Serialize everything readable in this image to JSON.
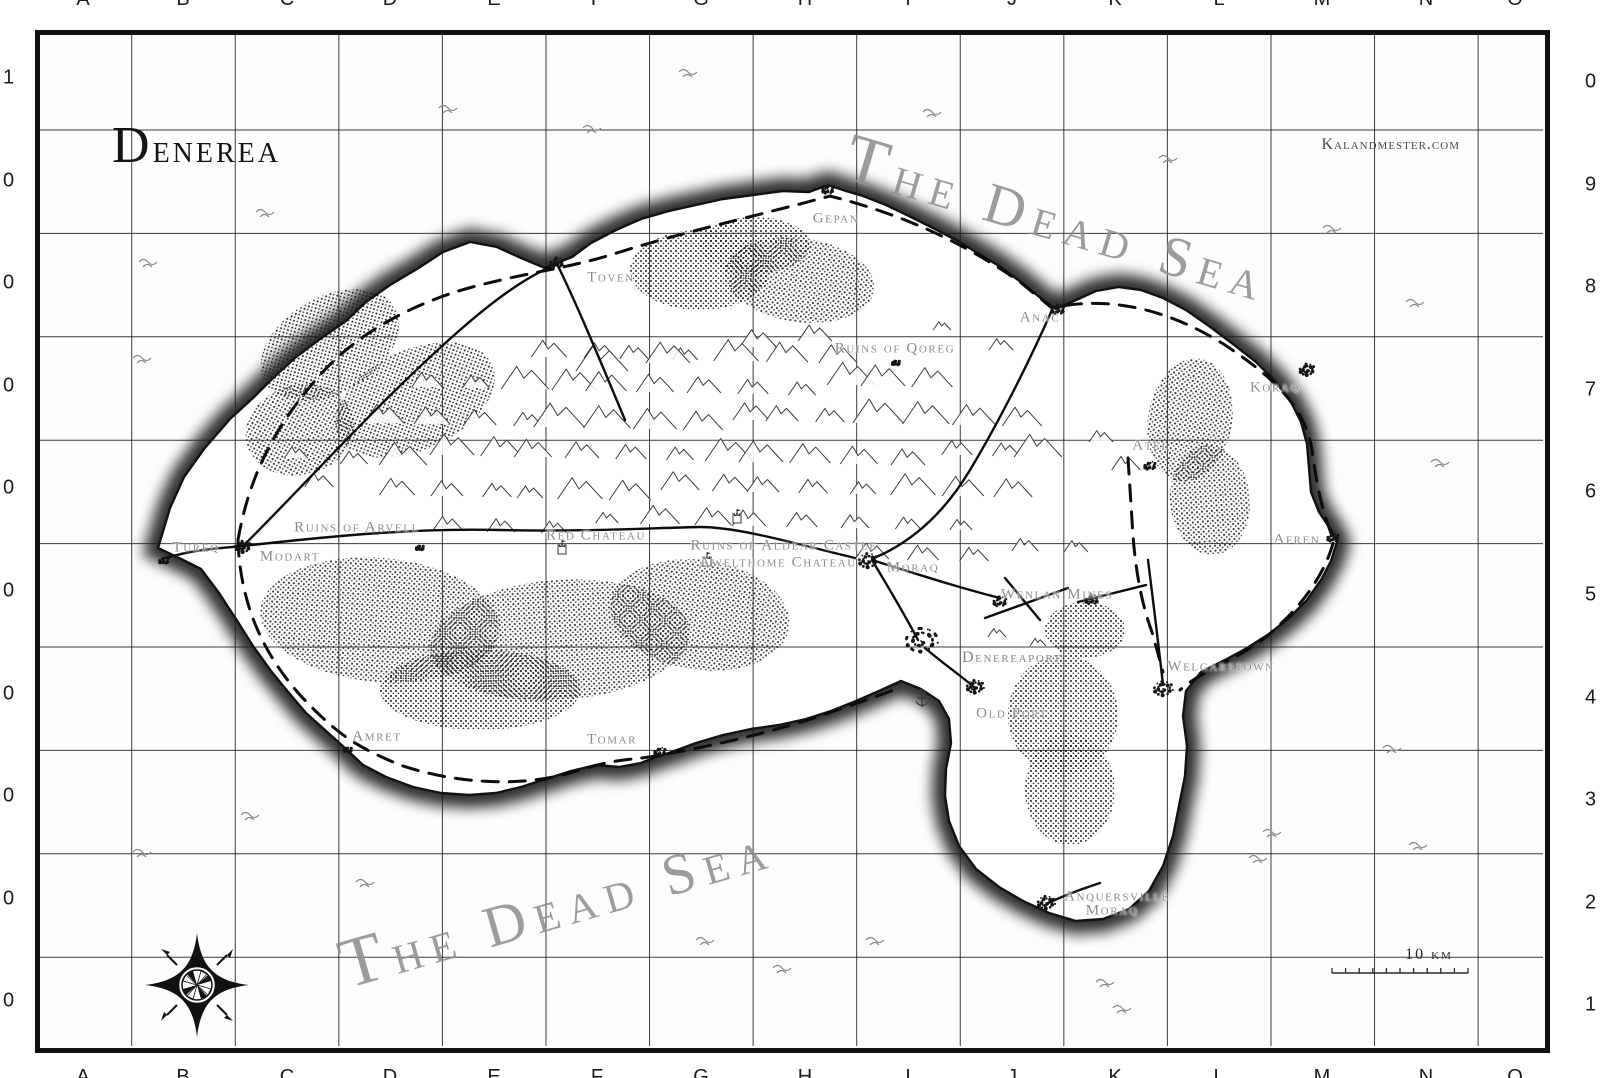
{
  "map": {
    "title": "Denerea",
    "attribution": "Kalandmester.com",
    "sea_label": "The Dead Sea",
    "grid": {
      "top_letters": [
        "A",
        "B",
        "C",
        "D",
        "E",
        "F",
        "G",
        "H",
        "I",
        "J",
        "K",
        "L",
        "M",
        "N",
        "O"
      ],
      "bottom_letters": [
        "A",
        "B",
        "C",
        "D",
        "E",
        "F",
        "G",
        "H",
        "I",
        "J",
        "K",
        "L",
        "M",
        "N",
        "O"
      ],
      "left_numbers_visible": [
        "1",
        "0",
        "0",
        "0",
        "0",
        "0",
        "0",
        "0",
        "0",
        "0"
      ],
      "right_numbers_visible": [
        "0",
        "9",
        "8",
        "7",
        "6",
        "5",
        "4",
        "3",
        "2",
        "1"
      ]
    },
    "scale": {
      "label": "10 km",
      "label_x": 1429,
      "label_y": 955,
      "bar_x1": 1332,
      "bar_x2": 1468,
      "bar_y": 973
    },
    "labels": [
      {
        "t": "Gepan",
        "x": 836,
        "y": 219
      },
      {
        "t": "Toven",
        "x": 611,
        "y": 278
      },
      {
        "t": "Anac",
        "x": 1040,
        "y": 318
      },
      {
        "t": "Ruins of Qoreg",
        "x": 895,
        "y": 349
      },
      {
        "t": "Koraq",
        "x": 1275,
        "y": 388
      },
      {
        "t": "Atel",
        "x": 1151,
        "y": 446
      },
      {
        "t": "Afren",
        "x": 1297,
        "y": 540
      },
      {
        "t": "Tureq",
        "x": 196,
        "y": 548
      },
      {
        "t": "Modart",
        "x": 290,
        "y": 557
      },
      {
        "t": "Ruins of Arvell",
        "x": 357,
        "y": 528
      },
      {
        "t": "Red Chateau",
        "x": 596,
        "y": 536
      },
      {
        "t": "Ruins of Aldear Castle",
        "x": 784,
        "y": 546
      },
      {
        "t": "Awelthome Chateau",
        "x": 778,
        "y": 563
      },
      {
        "t": "Moraq",
        "x": 913,
        "y": 568
      },
      {
        "t": "Wenlan Mines",
        "x": 1057,
        "y": 595
      },
      {
        "t": "Denereaport",
        "x": 1012,
        "y": 658,
        "big": true
      },
      {
        "t": "Old Port",
        "x": 1012,
        "y": 714
      },
      {
        "t": "Welgarstown",
        "x": 1221,
        "y": 667
      },
      {
        "t": "Amret",
        "x": 377,
        "y": 737
      },
      {
        "t": "Tomar",
        "x": 612,
        "y": 740
      },
      {
        "t": "Anquersville",
        "x": 1117,
        "y": 897
      },
      {
        "t": "Moraq",
        "x": 1112,
        "y": 911
      }
    ],
    "markers": [
      {
        "n": "tureq",
        "x": 164,
        "y": 561,
        "r": 5
      },
      {
        "n": "modart",
        "x": 243,
        "y": 547,
        "r": 8
      },
      {
        "n": "toven",
        "x": 557,
        "y": 263,
        "r": 7
      },
      {
        "n": "gepan",
        "x": 828,
        "y": 190,
        "r": 6
      },
      {
        "n": "anac",
        "x": 1058,
        "y": 310,
        "r": 7
      },
      {
        "n": "koraq",
        "x": 1307,
        "y": 370,
        "r": 8
      },
      {
        "n": "atel",
        "x": 1150,
        "y": 466,
        "r": 6
      },
      {
        "n": "afren",
        "x": 1333,
        "y": 538,
        "r": 6
      },
      {
        "n": "moraq",
        "x": 868,
        "y": 561,
        "r": 10
      },
      {
        "n": "denereaport",
        "x": 921,
        "y": 641,
        "r": 17
      },
      {
        "n": "old-port",
        "x": 975,
        "y": 687,
        "r": 9
      },
      {
        "n": "welgarstown",
        "x": 1163,
        "y": 689,
        "r": 10
      },
      {
        "n": "anquersville-moraq",
        "x": 1046,
        "y": 903,
        "r": 9
      },
      {
        "n": "tomar",
        "x": 660,
        "y": 752,
        "r": 6
      },
      {
        "n": "amret",
        "x": 348,
        "y": 750,
        "r": 4
      },
      {
        "n": "wenlan-mines-west",
        "x": 1000,
        "y": 602,
        "r": 7
      },
      {
        "n": "wenlan-mines-east",
        "x": 1092,
        "y": 600,
        "r": 7
      },
      {
        "n": "ruins-of-qoreg",
        "x": 896,
        "y": 363,
        "r": 4
      },
      {
        "n": "ruins-of-arvell",
        "x": 420,
        "y": 548,
        "r": 4
      }
    ],
    "castles": [
      {
        "n": "red-chateau",
        "x": 562,
        "y": 549
      },
      {
        "n": "aldear-castle",
        "x": 737,
        "y": 518
      },
      {
        "n": "awelthome-chateau",
        "x": 707,
        "y": 561
      }
    ],
    "anchor": {
      "x": 922,
      "y": 700
    },
    "island_path": "M158,548 L170,508 L184,477 L204,449 L230,419 L254,397 L272,379 L296,357 L320,339 L346,321 L366,302 L390,285 L417,269 L443,252 L470,242 L497,247 L521,258 L545,268 L557,263 L572,257 L591,243 L616,230 L641,219 L669,211 L696,205 L723,199 L753,195 L783,191 L809,192 L828,185 L846,191 L863,196 L886,205 L909,216 L933,228 L956,240 L976,252 L999,266 L1021,282 L1043,300 L1056,309 L1076,300 L1096,291 L1119,287 L1141,290 L1163,298 L1186,310 L1209,326 L1233,344 L1256,362 L1276,382 L1291,402 L1301,422 L1307,444 L1309,468 L1311,492 L1319,512 L1331,530 L1337,542 L1331,561 L1321,580 L1307,600 L1289,618 L1269,634 L1247,648 L1225,660 L1201,672 L1186,691 L1183,716 L1187,746 L1185,776 L1179,806 L1173,836 L1163,866 L1149,891 L1129,909 L1103,919 L1076,921 L1049,913 L1023,901 L999,887 L976,869 L959,846 L949,821 L945,796 L946,769 L951,743 L949,719 L939,701 L921,689 L901,681 L879,691 L856,701 L831,711 L806,719 L779,725 L751,729 L723,735 L696,743 L669,753 L656,757 L641,763 L619,767 L596,765 L571,771 L546,779 L521,787 L496,793 L469,795 L441,793 L413,787 L386,777 L363,765 L346,749 L326,731 L306,713 L289,693 L271,671 L253,646 L236,619 L219,593 L201,569 L181,559 Z",
    "routes_dashed": [
      "M238,540 C250,470 280,420 320,375 C360,330 420,300 480,285 C540,270 570,268 620,252 C680,233 760,215 830,196 C900,214 960,240 1020,282 L1052,308 C1110,295 1170,310 1225,345 C1270,375 1305,405 1312,450 C1318,495 1325,520 1334,540 C1325,575 1300,610 1262,640 C1230,663 1200,672 1180,690",
      "M238,540 C240,600 260,650 300,695 C340,738 360,748 400,765 C450,782 520,790 580,770 C620,757 640,760 660,755 C700,748 760,736 820,716 C860,702 880,695 900,688",
      "M1128,458 L1132,520 C1134,560 1140,600 1152,632 L1163,672"
    ],
    "routes_solid": [
      "M165,558 C200,548 225,548 243,546",
      "M243,546 C300,490 380,400 460,330 C500,295 530,275 557,264",
      "M557,264 C575,300 600,360 625,420",
      "M243,546 C340,535 420,528 500,530 C580,532 650,528 700,527 C740,527 800,545 855,558",
      "M1052,310 C1030,360 1000,420 970,470 C940,520 905,545 874,558",
      "M872,560 C890,590 905,615 918,640",
      "M872,560 C920,575 960,588 1000,598",
      "M985,618 L1068,588",
      "M1078,602 L1146,585",
      "M1005,578 L1040,620",
      "M925,648 C945,665 960,675 975,688",
      "M1163,685 C1158,640 1153,600 1148,560",
      "M1048,903 C1070,893 1085,888 1100,883"
    ],
    "forests": [
      {
        "cx": 330,
        "cy": 345,
        "rx": 75,
        "ry": 48,
        "rot": -30
      },
      {
        "cx": 415,
        "cy": 400,
        "rx": 85,
        "ry": 50,
        "rot": -25
      },
      {
        "cx": 300,
        "cy": 430,
        "rx": 55,
        "ry": 45,
        "rot": -15
      },
      {
        "cx": 700,
        "cy": 270,
        "rx": 70,
        "ry": 40,
        "rot": 0
      },
      {
        "cx": 800,
        "cy": 280,
        "rx": 75,
        "ry": 42,
        "rot": 8
      },
      {
        "cx": 755,
        "cy": 245,
        "rx": 55,
        "ry": 28,
        "rot": 0
      },
      {
        "cx": 1190,
        "cy": 420,
        "rx": 42,
        "ry": 62,
        "rot": 10
      },
      {
        "cx": 1210,
        "cy": 500,
        "rx": 40,
        "ry": 55,
        "rot": -5
      },
      {
        "cx": 380,
        "cy": 620,
        "rx": 120,
        "ry": 62,
        "rot": 5
      },
      {
        "cx": 560,
        "cy": 640,
        "rx": 130,
        "ry": 60,
        "rot": -4
      },
      {
        "cx": 700,
        "cy": 615,
        "rx": 90,
        "ry": 55,
        "rot": 8
      },
      {
        "cx": 480,
        "cy": 690,
        "rx": 100,
        "ry": 40,
        "rot": 0
      },
      {
        "cx": 1063,
        "cy": 715,
        "rx": 55,
        "ry": 60,
        "rot": 0
      },
      {
        "cx": 1070,
        "cy": 790,
        "rx": 45,
        "ry": 55,
        "rot": 0
      },
      {
        "cx": 1085,
        "cy": 630,
        "rx": 40,
        "ry": 28,
        "rot": 0
      }
    ],
    "mountain_rows": [
      {
        "y": 358,
        "x0": 545,
        "x1": 880,
        "step": 48,
        "s": 16
      },
      {
        "y": 390,
        "x0": 430,
        "x1": 960,
        "step": 46,
        "s": 17
      },
      {
        "y": 425,
        "x0": 385,
        "x1": 1025,
        "step": 45,
        "s": 18
      },
      {
        "y": 460,
        "x0": 355,
        "x1": 1090,
        "step": 46,
        "s": 17
      },
      {
        "y": 495,
        "x0": 395,
        "x1": 1050,
        "step": 47,
        "s": 16
      },
      {
        "y": 528,
        "x0": 455,
        "x1": 1000,
        "step": 50,
        "s": 14
      },
      {
        "y": 556,
        "x0": 880,
        "x1": 1080,
        "step": 48,
        "s": 12
      }
    ],
    "mountain_singles": [
      [
        608,
        375,
        26
      ],
      [
        660,
        368,
        20
      ],
      [
        300,
        455,
        13
      ],
      [
        320,
        488,
        12
      ],
      [
        1108,
        440,
        12
      ],
      [
        1130,
        472,
        11
      ],
      [
        990,
        640,
        10
      ],
      [
        1045,
        648,
        10
      ],
      [
        760,
        350,
        14
      ],
      [
        820,
        345,
        12
      ],
      [
        950,
        335,
        11
      ],
      [
        1000,
        352,
        10
      ]
    ],
    "waves": [
      [
        265,
        212
      ],
      [
        148,
        262
      ],
      [
        142,
        358
      ],
      [
        250,
        815
      ],
      [
        142,
        852
      ],
      [
        365,
        882
      ],
      [
        448,
        108
      ],
      [
        592,
        128
      ],
      [
        688,
        72
      ],
      [
        932,
        112
      ],
      [
        1168,
        158
      ],
      [
        1332,
        228
      ],
      [
        1415,
        302
      ],
      [
        1440,
        462
      ],
      [
        1392,
        748
      ],
      [
        1418,
        845
      ],
      [
        1272,
        832
      ],
      [
        1258,
        858
      ],
      [
        705,
        940
      ],
      [
        782,
        968
      ],
      [
        1105,
        982
      ],
      [
        1122,
        1008
      ],
      [
        875,
        940
      ]
    ]
  }
}
